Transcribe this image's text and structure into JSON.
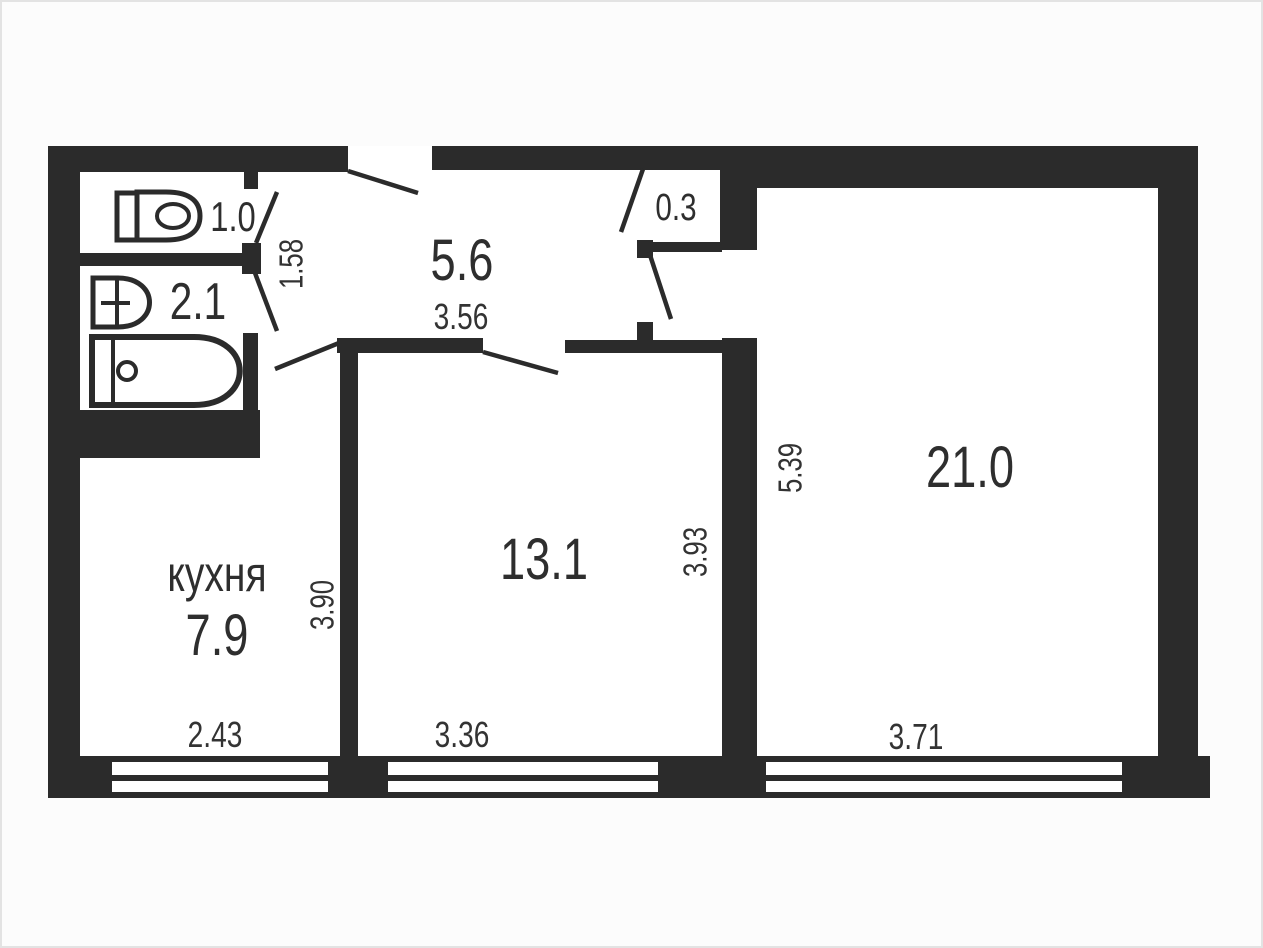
{
  "plan": {
    "rooms": {
      "toilet": {
        "area": "1.0"
      },
      "bathroom": {
        "area": "2.1"
      },
      "storage": {
        "area": "0.3"
      },
      "hallway": {
        "area": "5.6",
        "width_m": "3.56",
        "depth_m": "1.58"
      },
      "kitchen": {
        "name": "кухня",
        "area": "7.9",
        "width_m": "2.43",
        "depth_m": "3.90"
      },
      "bedroom": {
        "area": "13.1",
        "width_m": "3.36",
        "depth_m": "3.93"
      },
      "living": {
        "area": "21.0",
        "width_m": "3.71",
        "depth_m": "5.39"
      }
    },
    "colors": {
      "wall": "#2b2b2b",
      "floor": "#ffffff",
      "page_background": "#fcfcfc",
      "page_border": "#e3e3e3",
      "text": "#2e2e2e"
    },
    "icons": {
      "toilet": "toilet-top-view",
      "sink": "sink-top-view",
      "bathtub": "bathtub-top-view",
      "windows": "double-line-window-symbol",
      "doors": "door-swing-line"
    }
  }
}
